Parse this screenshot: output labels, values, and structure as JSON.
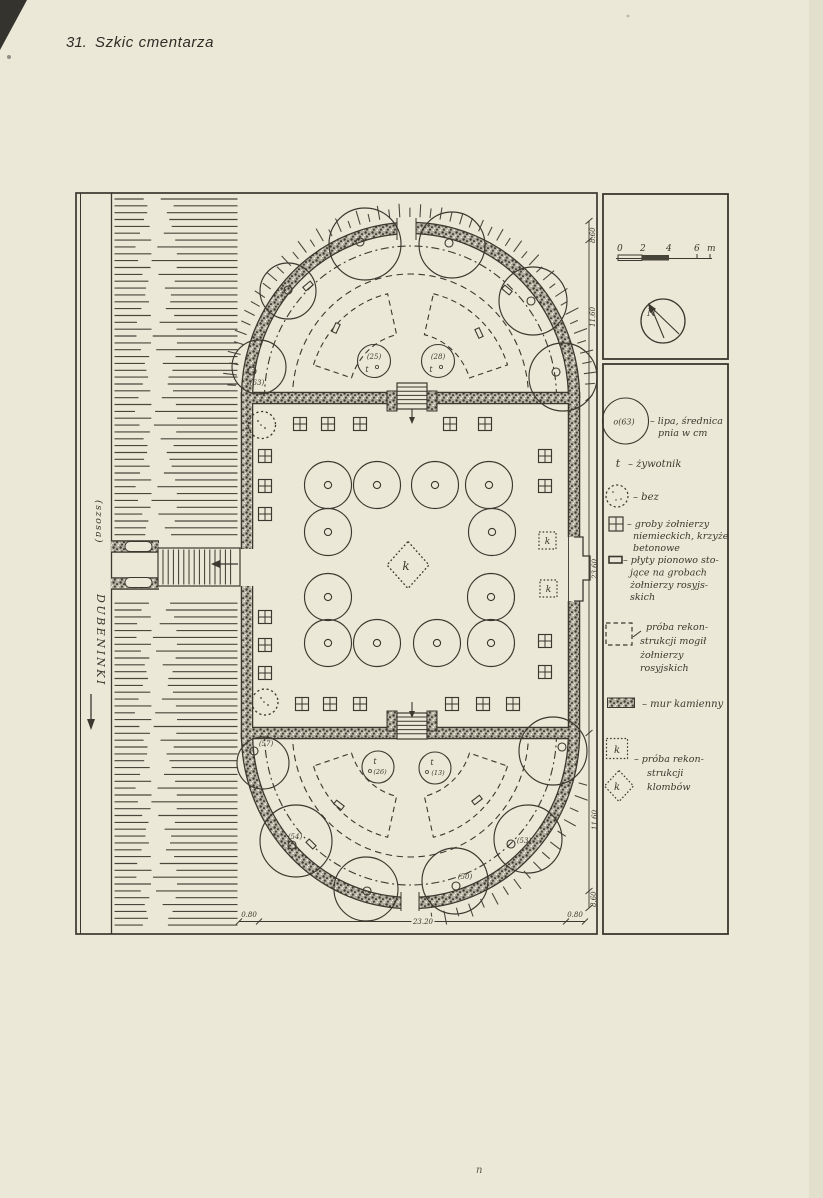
{
  "caption": {
    "number": "31.",
    "title": "Szkic cmentarza"
  },
  "figure": {
    "road": {
      "street": "(szosa)",
      "town": "DUBENINKI"
    },
    "scale_bar": {
      "t0": "0",
      "t2": "2",
      "t4": "4",
      "t6": "6",
      "unit": "m"
    },
    "compass": {
      "north": "N"
    },
    "tree_labels": {
      "t63": "(63)",
      "t25": "(25)",
      "t28": "(28)",
      "t57": "(57)",
      "t54": "(54)",
      "t53": "(53)",
      "t50": "(50)",
      "t26": "(26)",
      "t13": "(13)"
    },
    "tree_mark": "t",
    "flowerbed_mark": "k",
    "dimensions": {
      "right_top": "8.60",
      "right_upper": "11.60",
      "right_middle": "23.60",
      "right_lower": "11.60",
      "right_bottom": "8.60",
      "bottom_left": "0.80",
      "bottom_center": "23.20",
      "bottom_right": "0.80"
    },
    "page_mark": "n"
  },
  "legend": {
    "lipa": {
      "symbol": "o(63)",
      "line1": "– lipa, średnica",
      "line2": "pnia w cm"
    },
    "zywotnik": {
      "symbol": "t",
      "text": "– żywotnik"
    },
    "bez": {
      "text": "– bez"
    },
    "groby": {
      "line1": "– groby żołnierzy",
      "line2": "niemieckich, krzyże",
      "line3": "betonowe"
    },
    "plyty": {
      "line1": "– płyty pionowo sto-",
      "line2": "jące na grobach",
      "line3": "żołnierzy rosyjs-",
      "line4": "skich"
    },
    "rekonstrukcja_mogil": {
      "line1": "próba rekon-",
      "line2": "strukcji mogił",
      "line3": "żołnierzy",
      "line4": "rosyjskich"
    },
    "mur": {
      "text": "– mur kamienny"
    },
    "klomby": {
      "symbol": "k",
      "line1": "– próba rekon-",
      "line2": "strukcji",
      "line3": "klombów"
    }
  }
}
